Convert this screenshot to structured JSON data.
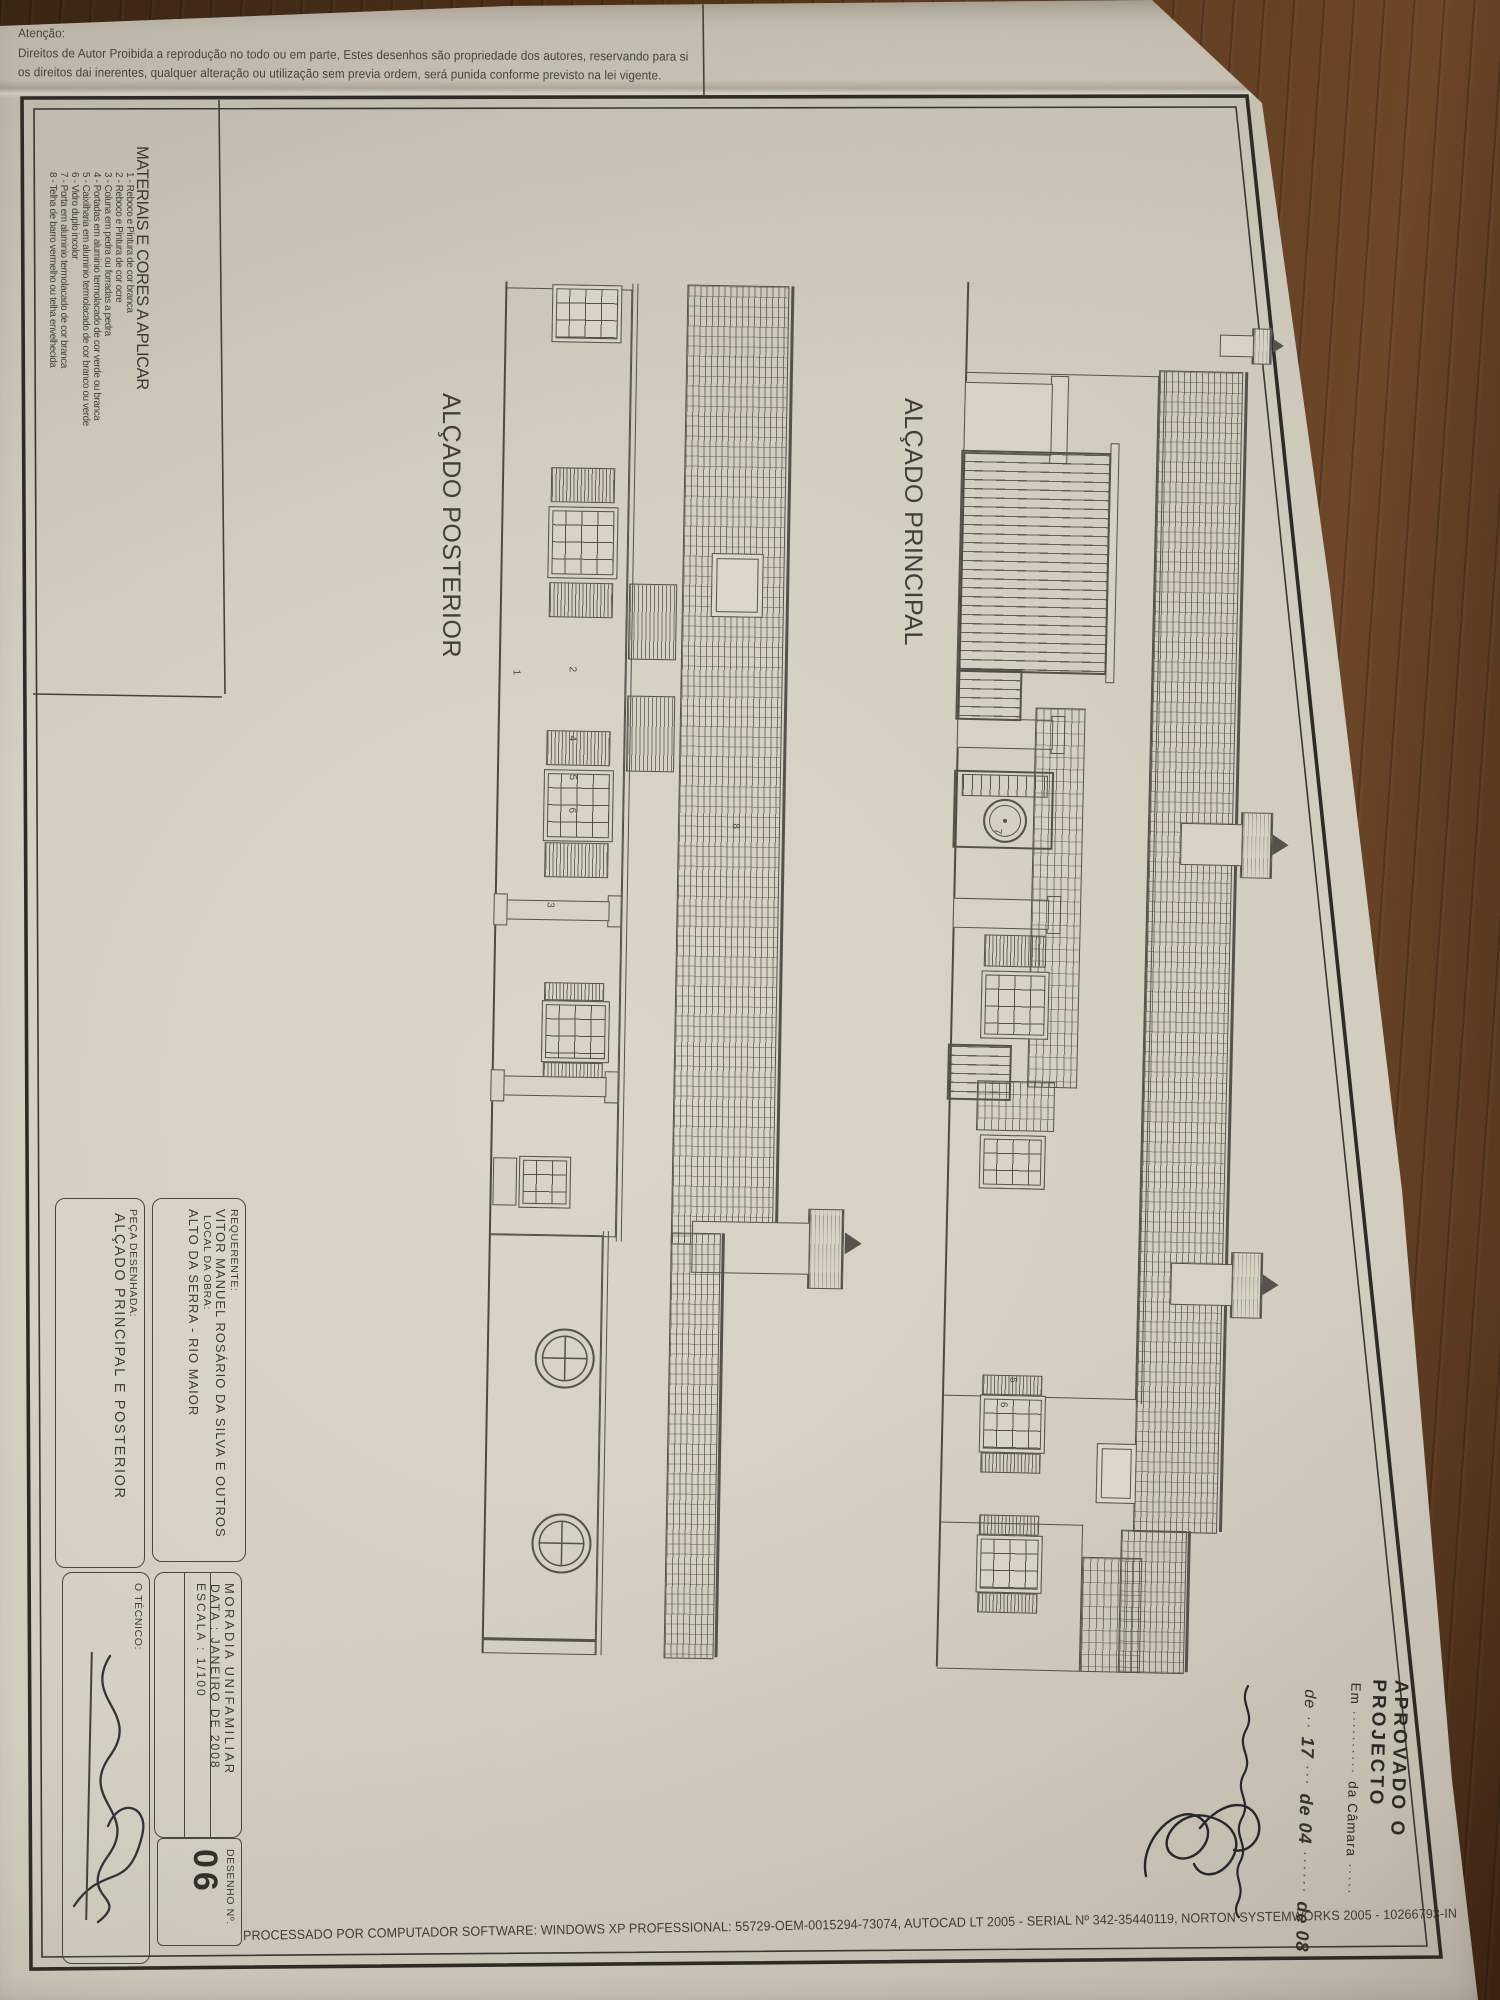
{
  "notice": {
    "attention": "Atenção:",
    "line1": "Direitos de Autor Proibida a reprodução no todo ou em parte, Estes desenhos são propriedade dos autores, reservando para si",
    "line2": "os direitos dai inerentes, qualquer alteração ou utilização sem previa ordem, será punida conforme previsto na lei vigente."
  },
  "materials": {
    "title": "MATERIAIS E CORES A APLICAR",
    "items": [
      "1 - Reboco e Pintura de cor branca",
      "2 - Reboco e Pintura de cor ocre",
      "3 - Coluna em pedra ou forradas a pedra",
      "4 - Portadas em aluminio termolacado de cor verde ou branca",
      "5 - Caixilharia em aluminio termolacado de cor branco ou verde",
      "6 - Vidro duplo incolor",
      "7 - Porta em aluminio termolacado de cor branca",
      "8 - Telha de barro vermelho ou telha envelhecida"
    ]
  },
  "drawings": {
    "posterior": {
      "title": "ALÇADO POSTERIOR",
      "callouts": [
        "1",
        "2",
        "4",
        "5",
        "6",
        "3",
        "8"
      ]
    },
    "principal": {
      "title": "ALÇADO PRINCIPAL",
      "callouts": [
        "7",
        "5",
        "6"
      ]
    }
  },
  "titleblock": {
    "requerente_label": "REQUERENTE:",
    "requerente_value": "VITOR MANUEL ROSÁRIO DA SILVA E OUTROS",
    "local_label": "LOCAL DA OBRA:",
    "local_value": "ALTO DA SERRA - RIO MAIOR",
    "peca_label": "PEÇA DESENHADA:",
    "peca_value": "ALÇADO PRINCIPAL E POSTERIOR",
    "moradia": "MORADIA UNIFAMILIAR",
    "data": "DATA : JANEIRO DE 2008",
    "escala": "ESCALA : 1/100",
    "tecnico_label": "O TÉCNICO:",
    "desenho_label": "DESENHO  Nº.",
    "desenho_numero": "06"
  },
  "stamp": {
    "approved": "APROVADO O PROJECTO",
    "em_label": "Em",
    "camara": "da Câmara",
    "de1": "de",
    "day": "17",
    "de2": "de 04",
    "de3": "de 08"
  },
  "footer": {
    "processed": "PROCESSADO POR COMPUTADOR SOFTWARE: WINDOWS XP PROFESSIONAL: 55729-OEM-0015294-73074, AUTOCAD LT 2005 - SERIAL Nº 342-35440119, NORTON SYSTEMWORKS 2005 - 10266793-IN"
  }
}
